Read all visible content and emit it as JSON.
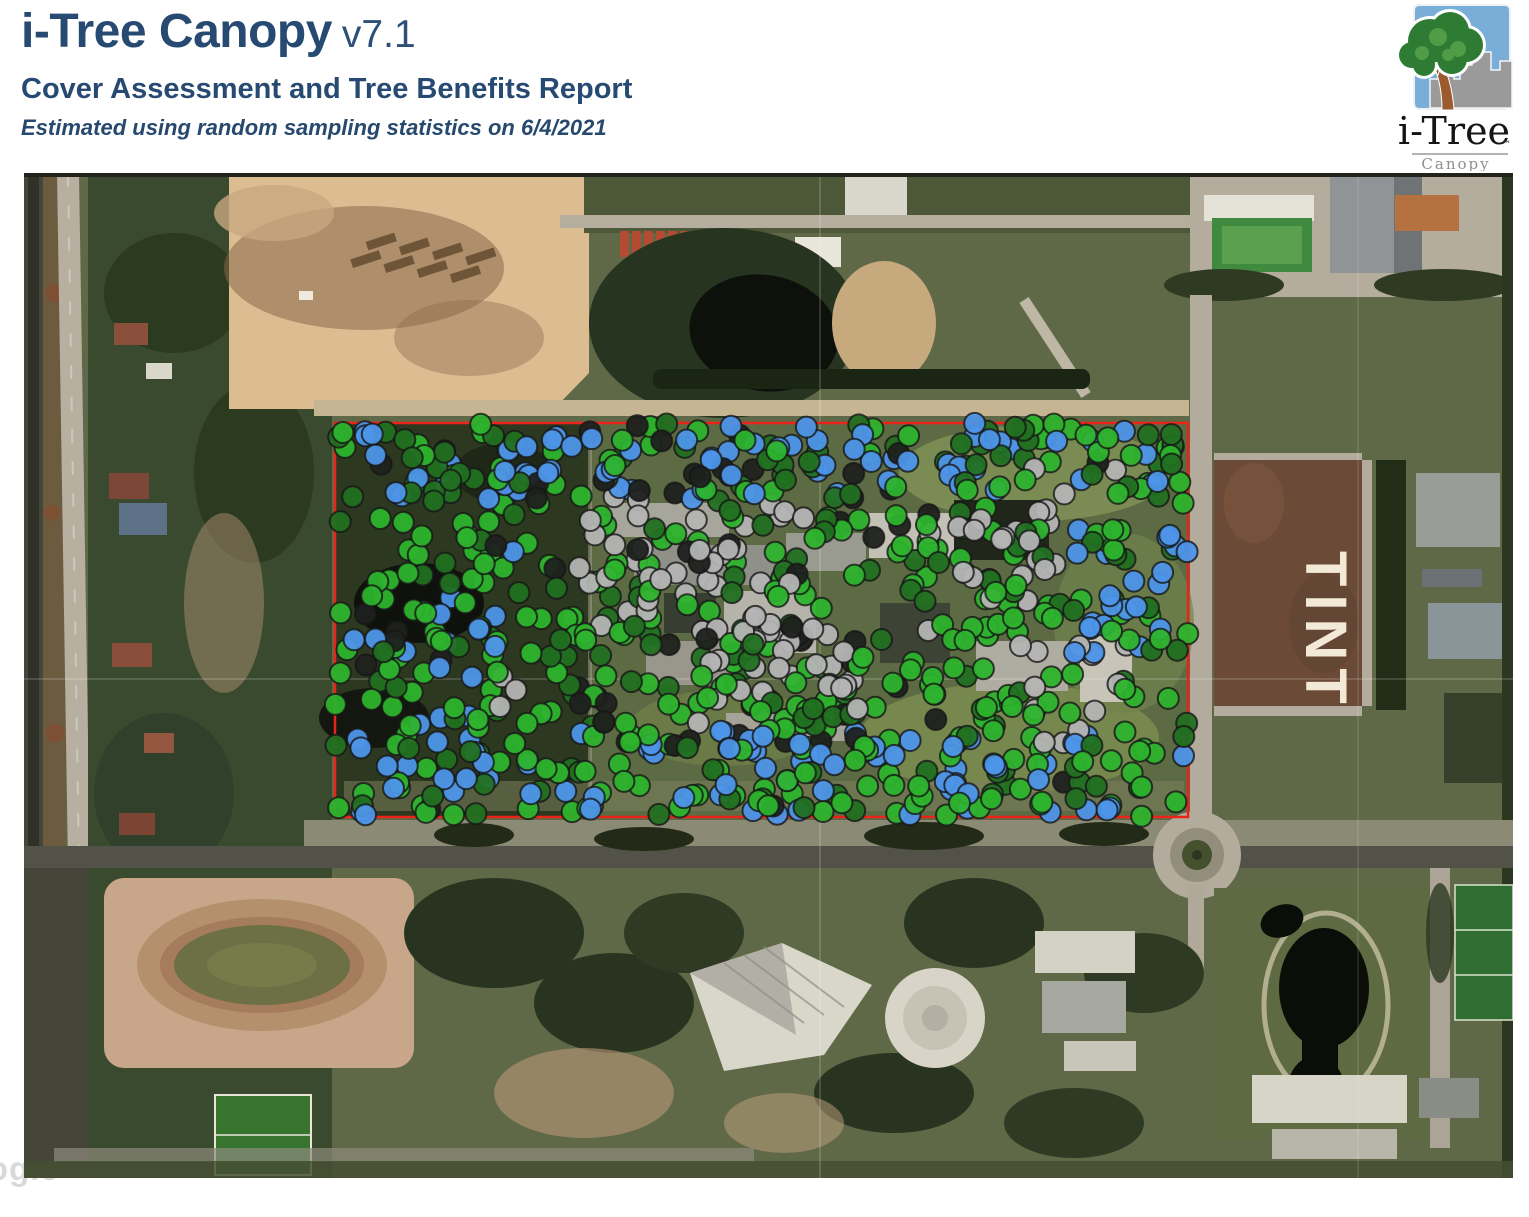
{
  "header": {
    "title": "i-Tree Canopy",
    "version": "v7.1",
    "subtitle": "Cover Assessment and Tree Benefits Report",
    "subnote": "Estimated using random sampling statistics on 6/4/2021",
    "accent_color": "#264a72"
  },
  "logo": {
    "brand": "i-Tree",
    "trademark": "™",
    "product": "Canopy",
    "sky_color": "#79aed9",
    "canopy_color": "#2e7b33",
    "trunk_color": "#9c5b2e",
    "city_color": "#9a9a9a"
  },
  "map": {
    "watermark_text": "Google",
    "field_label": "TINT",
    "boundary_color": "#ea2418",
    "sampling": {
      "seed": 7,
      "dot_radius": 10.5,
      "dot_stroke_color": "#171717",
      "dot_stroke_width": 2,
      "dot_fill_opacity": 0.95,
      "boundary": {
        "x": 311,
        "y": 250,
        "width": 853,
        "height": 394
      },
      "overflow": 8,
      "classes": [
        {
          "name": "cover-class-bright-green",
          "color": "#2db32d",
          "zones": [
            {
              "x": 311,
              "y": 250,
              "w": 853,
              "h": 394,
              "count": 330
            }
          ]
        },
        {
          "name": "cover-class-dark-green",
          "color": "#217021",
          "zones": [
            {
              "x": 311,
              "y": 250,
              "w": 853,
              "h": 394,
              "count": 150
            },
            {
              "x": 311,
              "y": 250,
              "w": 853,
              "h": 80,
              "count": 30
            }
          ]
        },
        {
          "name": "cover-class-blue",
          "color": "#4d95e8",
          "zones": [
            {
              "x": 330,
              "y": 252,
              "w": 830,
              "h": 75,
              "count": 62
            },
            {
              "x": 325,
              "y": 555,
              "w": 840,
              "h": 88,
              "count": 72
            },
            {
              "x": 1050,
              "y": 350,
              "w": 114,
              "h": 140,
              "count": 22
            },
            {
              "x": 330,
              "y": 420,
              "w": 160,
              "h": 140,
              "count": 14
            },
            {
              "x": 311,
              "y": 250,
              "w": 853,
              "h": 394,
              "count": 10
            }
          ]
        },
        {
          "name": "cover-class-gray",
          "color": "#b4b4b4",
          "zones": [
            {
              "x": 555,
              "y": 320,
              "w": 230,
              "h": 140,
              "count": 38
            },
            {
              "x": 660,
              "y": 430,
              "w": 200,
              "h": 120,
              "count": 28
            },
            {
              "x": 895,
              "y": 320,
              "w": 150,
              "h": 110,
              "count": 18
            },
            {
              "x": 985,
              "y": 470,
              "w": 130,
              "h": 100,
              "count": 12
            },
            {
              "x": 450,
              "y": 280,
              "w": 650,
              "h": 340,
              "count": 10
            }
          ]
        },
        {
          "name": "cover-class-black",
          "color": "#1f211e",
          "zones": [
            {
              "x": 311,
              "y": 250,
              "w": 853,
              "h": 394,
              "count": 34
            },
            {
              "x": 555,
              "y": 370,
              "w": 280,
              "h": 200,
              "count": 18
            },
            {
              "x": 560,
              "y": 255,
              "w": 320,
              "h": 70,
              "count": 10
            },
            {
              "x": 600,
              "y": 560,
              "w": 250,
              "h": 80,
              "count": 6
            }
          ]
        }
      ]
    }
  }
}
